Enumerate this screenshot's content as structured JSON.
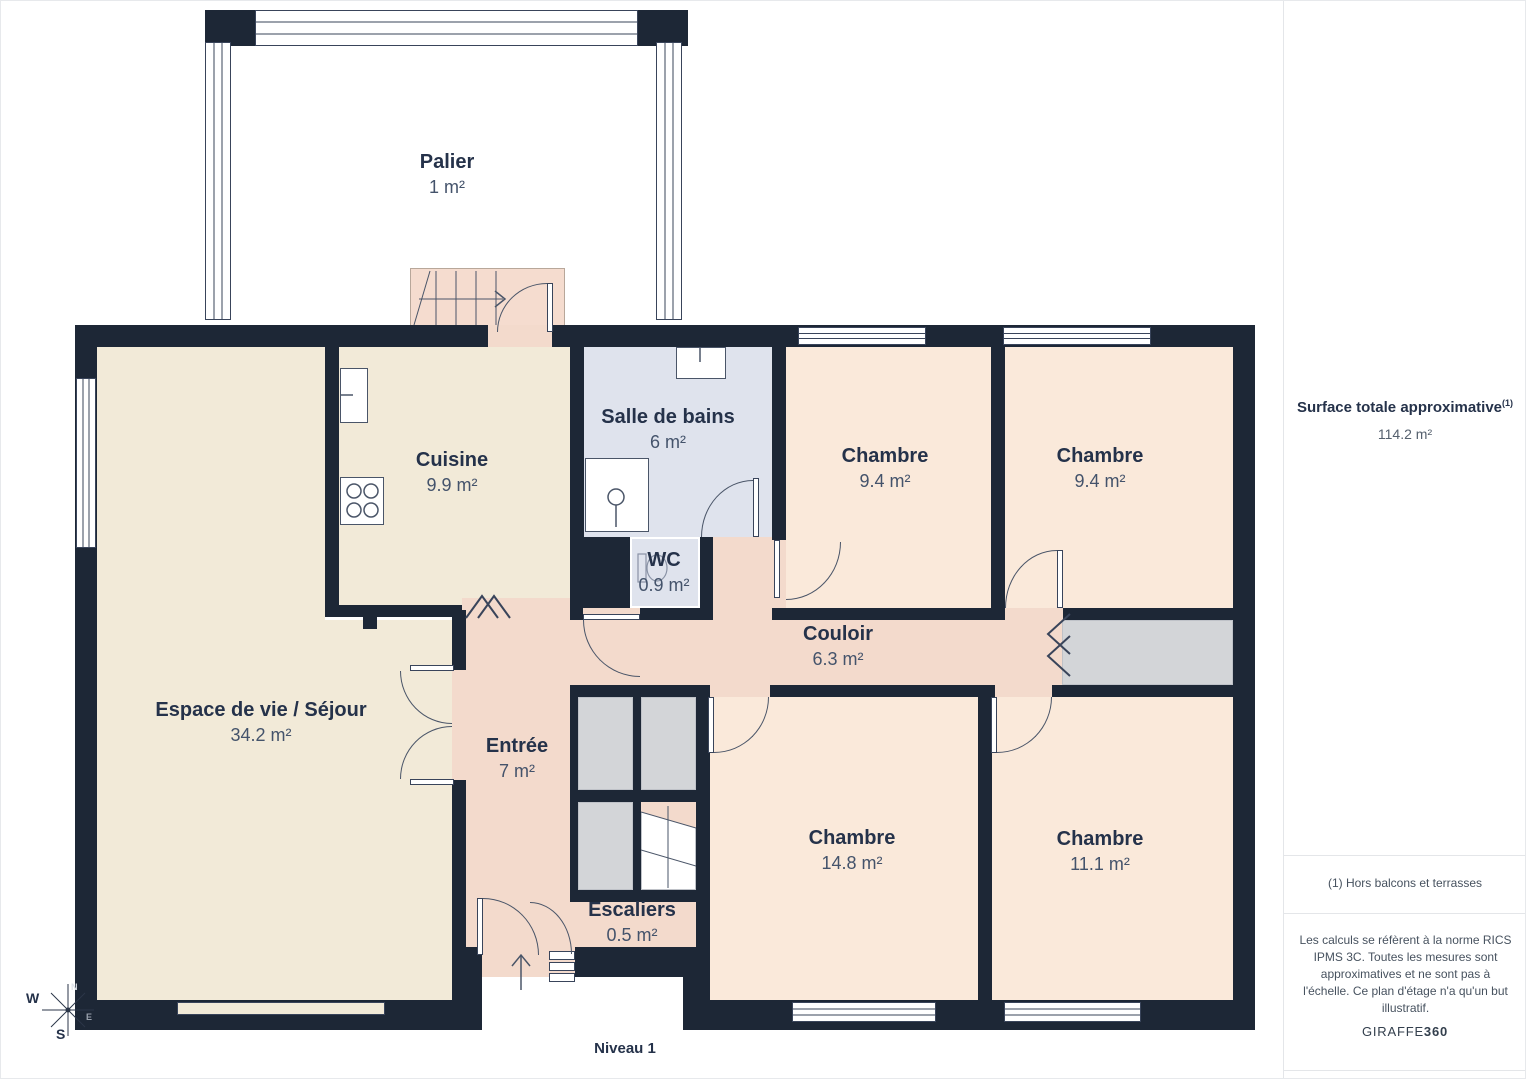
{
  "palette": {
    "wall": "#1d2736",
    "floor_living": "#f2ead8",
    "floor_bedroom": "#fae9da",
    "floor_hall": "#f3dacc",
    "floor_bath": "#dfe3ed",
    "closet_grey": "#d3d5d8",
    "text_dark": "#25324a"
  },
  "plan": {
    "level_label": "Niveau 1",
    "rooms": {
      "palier": {
        "name": "Palier",
        "area": "1 m²"
      },
      "cuisine": {
        "name": "Cuisine",
        "area": "9.9 m²"
      },
      "salle_de_bains": {
        "name": "Salle de bains",
        "area": "6 m²"
      },
      "chambre_nord_ouest": {
        "name": "Chambre",
        "area": "9.4 m²"
      },
      "chambre_nord_est": {
        "name": "Chambre",
        "area": "9.4 m²"
      },
      "wc": {
        "name": "WC",
        "area": "0.9 m²"
      },
      "couloir": {
        "name": "Couloir",
        "area": "6.3 m²"
      },
      "sejour": {
        "name": "Espace de vie / Séjour",
        "area": "34.2 m²"
      },
      "entree": {
        "name": "Entrée",
        "area": "7 m²"
      },
      "chambre_sud_ouest": {
        "name": "Chambre",
        "area": "14.8 m²"
      },
      "chambre_sud_est": {
        "name": "Chambre",
        "area": "11.1 m²"
      },
      "escaliers": {
        "name": "Escaliers",
        "area": "0.5 m²"
      }
    },
    "compass": {
      "n": "N",
      "e": "E",
      "s": "S",
      "w": "W"
    }
  },
  "sidebar": {
    "title": "Surface totale approximative",
    "title_footnote_marker": "(1)",
    "total_area": "114.2 m²",
    "footnote": "(1) Hors balcons et terrasses",
    "disclaimer": "Les calculs se réfèrent à la norme RICS IPMS 3C. Toutes les mesures sont approximatives et ne sont pas à l'échelle. Ce plan d'étage n'a qu'un but illustratif.",
    "brand_name": "GIRAFFE",
    "brand_suffix": "360"
  }
}
